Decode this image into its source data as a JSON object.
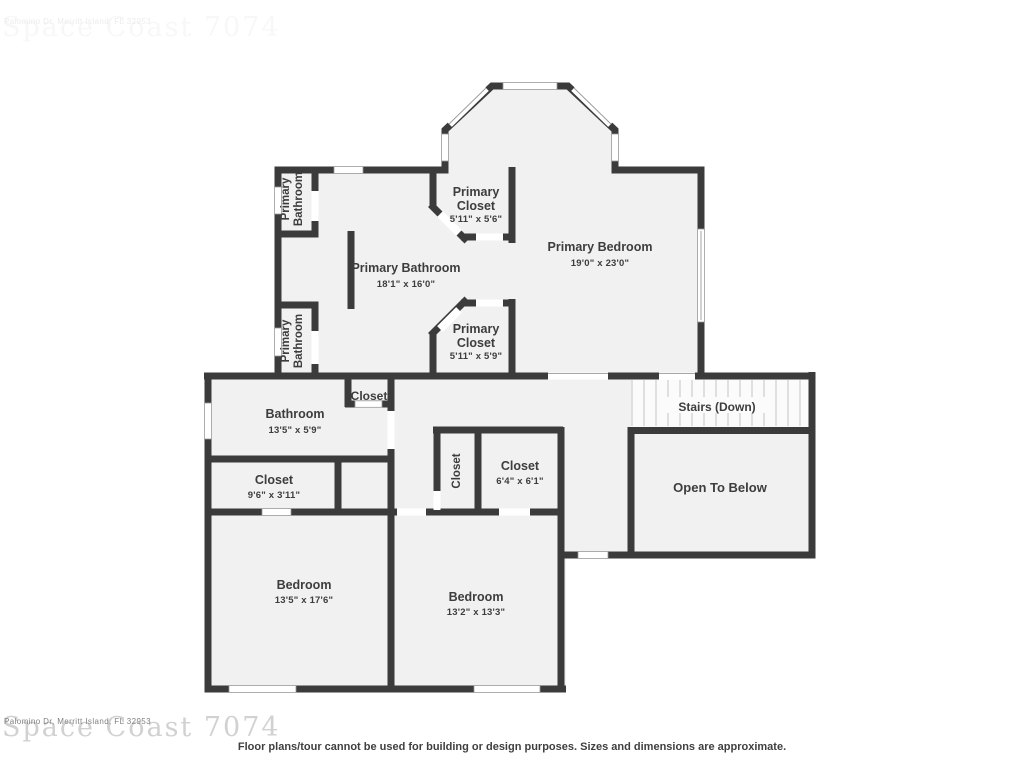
{
  "watermarks": {
    "top": {
      "brand": "Space Coast 7074",
      "address": "Palomino Dr, Merritt Island, FL 32953"
    },
    "bottom": {
      "brand": "Space Coast 7074",
      "address": "Palomino Dr, Merritt Island, FL 32953"
    }
  },
  "rooms": {
    "primary_bathroom_upper": {
      "line1": "Primary",
      "line2": "Bathroom"
    },
    "primary_closet_upper": {
      "line1": "Primary",
      "line2": "Closet",
      "dims": "5'11\" x 5'6\""
    },
    "primary_bedroom": {
      "name": "Primary Bedroom",
      "dims": "19'0\" x 23'0\""
    },
    "primary_bathroom_main": {
      "name": "Primary Bathroom",
      "dims": "18'1\" x 16'0\""
    },
    "primary_bathroom_lower": {
      "line1": "Primary",
      "line2": "Bathroom"
    },
    "primary_closet_lower": {
      "line1": "Primary",
      "line2": "Closet",
      "dims": "5'11\" x 5'9\""
    },
    "hall_closet": {
      "name": "Closet"
    },
    "bathroom": {
      "name": "Bathroom",
      "dims": "13'5\" x 5'9\""
    },
    "closet_bedroom1": {
      "name": "Closet",
      "dims": "9'6\" x 3'11\""
    },
    "closet_narrow": {
      "name": "Closet"
    },
    "closet_bedroom2": {
      "name": "Closet",
      "dims": "6'4\" x 6'1\""
    },
    "stairs": {
      "name": "Stairs (Down)"
    },
    "open_to_below": {
      "name": "Open To Below"
    },
    "bedroom_left": {
      "name": "Bedroom",
      "dims": "13'5\" x 17'6\""
    },
    "bedroom_right": {
      "name": "Bedroom",
      "dims": "13'2\" x 13'3\""
    }
  },
  "footer": {
    "disclaimer": "Floor plans/tour cannot be used for building or design purposes. Sizes and dimensions are approximate."
  },
  "colors": {
    "wall": "#3b3b3b",
    "room_fill": "#f1f1f1",
    "label_text": "#3d3d3d",
    "window_frame": "#9a9a9a"
  }
}
